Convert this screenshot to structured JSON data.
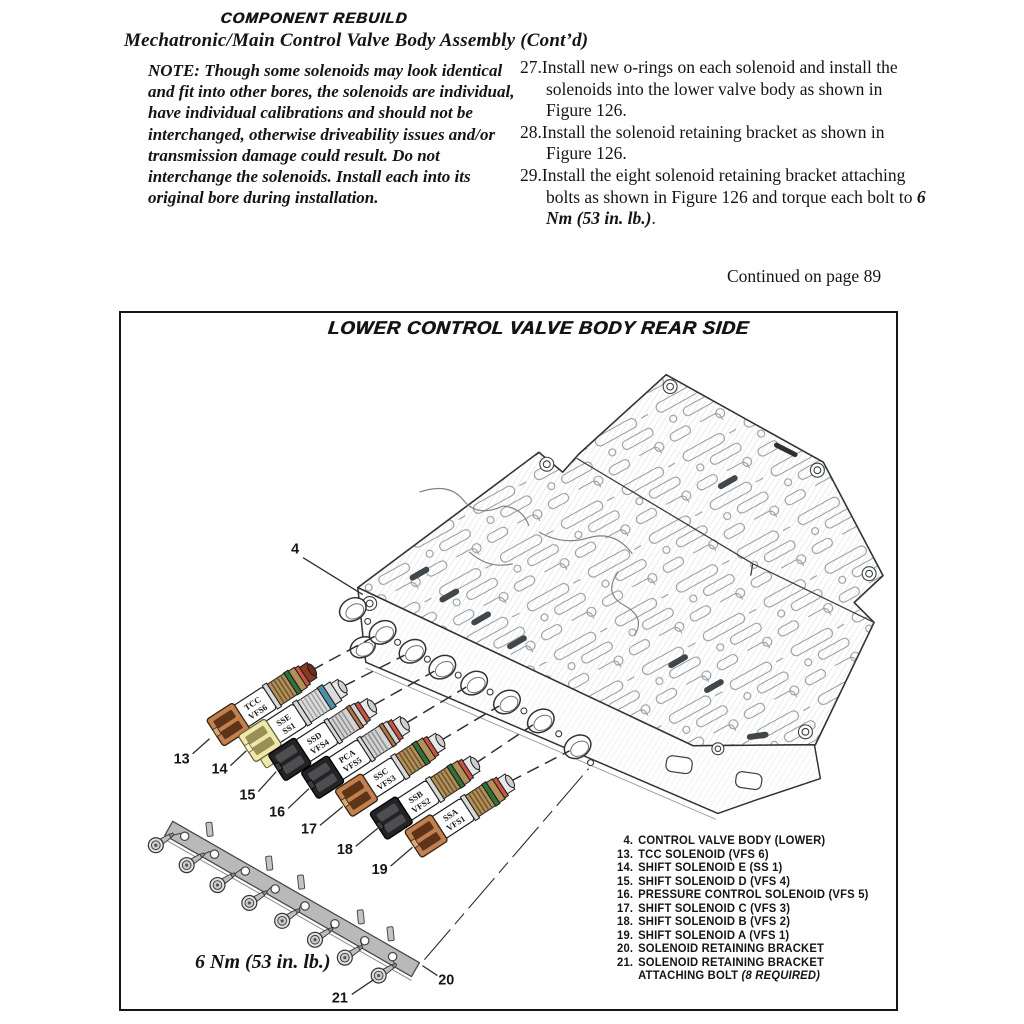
{
  "page": {
    "kicker": "COMPONENT REBUILD",
    "title": "Mechatronic/Main Control Valve Body Assembly (Cont’d)",
    "continued": "Continued on page 89"
  },
  "note": {
    "text": "NOTE: Though some solenoids may look identical and fit into other bores, the solenoids are individual, have individual calibrations and should not be interchanged, otherwise driveability issues and/or transmission damage could result. Do not interchange the solenoids. Install each into its original bore during installation."
  },
  "steps": [
    {
      "num": "27.",
      "text": "Install new o-rings on each solenoid and install the solenoids into the lower valve body as shown in Figure 126.",
      "bold": "",
      "after": ""
    },
    {
      "num": "28.",
      "text": "Install the solenoid retaining bracket as shown in Figure 126.",
      "bold": "",
      "after": ""
    },
    {
      "num": "29.",
      "text": "Install the eight solenoid retaining bracket attaching bolts as shown in Figure 126 and torque each bolt to ",
      "bold": "6 Nm (53 in. lb.)",
      "after": "."
    }
  ],
  "figure": {
    "title": "LOWER CONTROL VALVE BODY REAR SIDE",
    "torque": "6 Nm (53 in. lb.)",
    "callouts": {
      "c4": "4",
      "c13": "13",
      "c14": "14",
      "c15": "15",
      "c16": "16",
      "c17": "17",
      "c18": "18",
      "c19": "19",
      "c20": "20",
      "c21": "21"
    },
    "solenoids": [
      {
        "line1": "TCC",
        "line2": "VFS6"
      },
      {
        "line1": "SSE",
        "line2": "SS1"
      },
      {
        "line1": "SSD",
        "line2": "VFS4"
      },
      {
        "line1": "PCA",
        "line2": "VFS5"
      },
      {
        "line1": "SSC",
        "line2": "VFS3"
      },
      {
        "line1": "SSB",
        "line2": "VFS2"
      },
      {
        "line1": "SSA",
        "line2": "VFS1"
      }
    ],
    "legend": [
      {
        "num": "4.",
        "text": "CONTROL VALVE BODY (LOWER)",
        "italic": ""
      },
      {
        "num": "13.",
        "text": "TCC SOLENOID (VFS 6)",
        "italic": ""
      },
      {
        "num": "14.",
        "text": "SHIFT SOLENOID E (SS 1)",
        "italic": ""
      },
      {
        "num": "15.",
        "text": "SHIFT SOLENOID D (VFS 4)",
        "italic": ""
      },
      {
        "num": "16.",
        "text": "PRESSURE CONTROL SOLENOID (VFS 5)",
        "italic": ""
      },
      {
        "num": "17.",
        "text": "SHIFT SOLENOID C (VFS 3)",
        "italic": ""
      },
      {
        "num": "18.",
        "text": "SHIFT SOLENOID B (VFS 2)",
        "italic": ""
      },
      {
        "num": "19.",
        "text": "SHIFT SOLENOID A (VFS 1)",
        "italic": ""
      },
      {
        "num": "20.",
        "text": "SOLENOID RETAINING BRACKET",
        "italic": ""
      },
      {
        "num": "21.",
        "text": "SOLENOID RETAINING BRACKET",
        "italic": ""
      },
      {
        "num": "",
        "text": "ATTACHING BOLT ",
        "italic": "(8 REQUIRED)"
      }
    ],
    "colors": {
      "connector_orange": "#c08050",
      "connector_yellow": "#efe8ac",
      "connector_black": "#232325",
      "band_green": "#33703a",
      "band_blue": "#4f8fae",
      "oring_red": "#cc5243",
      "bracket_gray": "#b9b9b9"
    }
  }
}
